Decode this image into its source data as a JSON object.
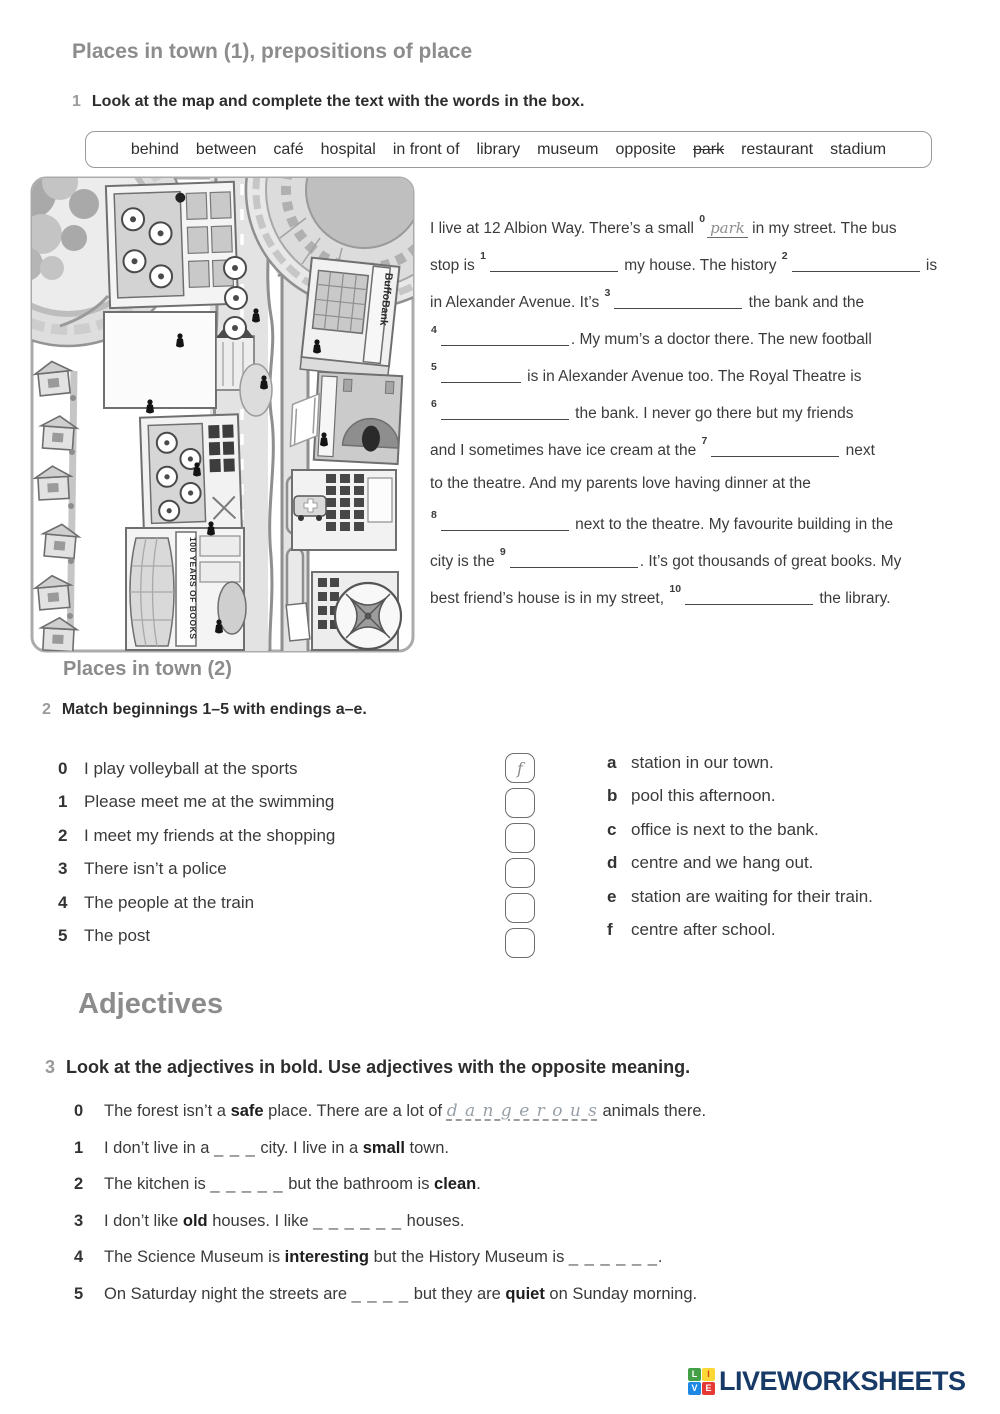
{
  "page": {
    "title": "Places in town (1), prepositions of place"
  },
  "exercise1": {
    "number": "1",
    "instruction": "Look at the map and complete the text with the words in the box.",
    "word_box": [
      "behind",
      "between",
      "café",
      "hospital",
      "in front of",
      "library",
      "museum",
      "opposite",
      "park",
      "restaurant",
      "stadium"
    ],
    "struck_word": "park",
    "map_labels": {
      "bank": "BuffoBank",
      "library_banner": "100 YEARS OF BOOKS"
    },
    "text_lines": [
      [
        {
          "t": "I live at 12 Albion Way. There’s a small "
        },
        {
          "sup": "0"
        },
        {
          "ans": "park"
        },
        {
          "t": " in my street. The bus"
        }
      ],
      [
        {
          "t": "stop is "
        },
        {
          "sup": "1"
        },
        {
          "blank": 128
        },
        {
          "t": " my house. The history "
        },
        {
          "sup": "2"
        },
        {
          "blank": 128
        },
        {
          "t": " is"
        }
      ],
      [
        {
          "t": "in Alexander Avenue. It’s "
        },
        {
          "sup": "3"
        },
        {
          "blank": 128
        },
        {
          "t": " the bank and the"
        }
      ],
      [
        {
          "sup": "4"
        },
        {
          "blank": 128
        },
        {
          "t": ". My mum’s a doctor there. The new football"
        }
      ],
      [
        {
          "sup": "5"
        },
        {
          "blank": 80
        },
        {
          "t": " is in Alexander Avenue too. The Royal Theatre is"
        }
      ],
      [
        {
          "sup": "6"
        },
        {
          "blank": 128
        },
        {
          "t": " the bank. I never go there but my friends"
        }
      ],
      [
        {
          "t": "and I sometimes have ice cream at the "
        },
        {
          "sup": "7"
        },
        {
          "blank": 128
        },
        {
          "t": " next"
        }
      ],
      [
        {
          "t": "to the theatre. And my parents love having dinner at the"
        }
      ],
      [
        {
          "sup": "8"
        },
        {
          "blank": 128
        },
        {
          "t": " next to the theatre. My favourite building in the"
        }
      ],
      [
        {
          "t": "city is the "
        },
        {
          "sup": "9"
        },
        {
          "blank": 128
        },
        {
          "t": ". It’s got thousands of great books. My"
        }
      ],
      [
        {
          "t": "best friend’s house is in my street, "
        },
        {
          "sup": "10"
        },
        {
          "blank": 128
        },
        {
          "t": " the library."
        }
      ]
    ]
  },
  "exercise2": {
    "heading": "Places in town (2)",
    "number": "2",
    "instruction": "Match beginnings 1–5 with endings a–e.",
    "beginnings": [
      {
        "num": "0",
        "text": "I play volleyball at the sports",
        "answer": "f"
      },
      {
        "num": "1",
        "text": "Please meet me at the swimming",
        "answer": ""
      },
      {
        "num": "2",
        "text": "I meet my friends at the shopping",
        "answer": ""
      },
      {
        "num": "3",
        "text": "There isn’t a police",
        "answer": ""
      },
      {
        "num": "4",
        "text": "The people at the train",
        "answer": ""
      },
      {
        "num": "5",
        "text": "The post",
        "answer": ""
      }
    ],
    "endings": [
      {
        "letter": "a",
        "text": "station in our town."
      },
      {
        "letter": "b",
        "text": "pool this afternoon."
      },
      {
        "letter": "c",
        "text": "office is next to the bank."
      },
      {
        "letter": "d",
        "text": "centre and we hang out."
      },
      {
        "letter": "e",
        "text": "station are waiting for their train."
      },
      {
        "letter": "f",
        "text": "centre after school."
      }
    ]
  },
  "exercise3": {
    "heading": "Adjectives",
    "number": "3",
    "instruction": "Look at the adjectives in bold. Use adjectives with the opposite meaning.",
    "items": [
      {
        "num": "0",
        "segments": [
          {
            "t": "The forest isn’t a "
          },
          {
            "b": "safe"
          },
          {
            "t": " place. There are a lot of "
          },
          {
            "hw": "d a n g e r o u s"
          },
          {
            "t": " animals there."
          }
        ]
      },
      {
        "num": "1",
        "segments": [
          {
            "t": "I don’t live in a "
          },
          {
            "u": "_ _ _"
          },
          {
            "t": " city. I live in a "
          },
          {
            "b": "small"
          },
          {
            "t": " town."
          }
        ]
      },
      {
        "num": "2",
        "segments": [
          {
            "t": "The kitchen is "
          },
          {
            "u": "_ _ _ _ _"
          },
          {
            "t": " but the bathroom is "
          },
          {
            "b": "clean"
          },
          {
            "t": "."
          }
        ]
      },
      {
        "num": "3",
        "segments": [
          {
            "t": "I don’t like "
          },
          {
            "b": "old"
          },
          {
            "t": " houses. I like "
          },
          {
            "u": "_ _ _ _ _ _"
          },
          {
            "t": " houses."
          }
        ]
      },
      {
        "num": "4",
        "segments": [
          {
            "t": "The Science Museum is "
          },
          {
            "b": "interesting"
          },
          {
            "t": " but the History Museum is "
          },
          {
            "u": "_ _ _ _ _ _"
          },
          {
            "t": "."
          }
        ]
      },
      {
        "num": "5",
        "segments": [
          {
            "t": "On Saturday night the streets are "
          },
          {
            "u": "_ _ _ _"
          },
          {
            "t": " but they are "
          },
          {
            "b": "quiet"
          },
          {
            "t": " on Sunday morning."
          }
        ]
      }
    ]
  },
  "footer": {
    "logo_text": "LIVEWORKSHEETS",
    "logo_squares": [
      {
        "letter": "L",
        "bg": "#43a047",
        "fg": "#ffffff"
      },
      {
        "letter": "I",
        "bg": "#fdd835",
        "fg": "#d84315"
      },
      {
        "letter": "V",
        "bg": "#1e88e5",
        "fg": "#ffffff"
      },
      {
        "letter": "E",
        "bg": "#e53935",
        "fg": "#ffffff"
      }
    ]
  }
}
